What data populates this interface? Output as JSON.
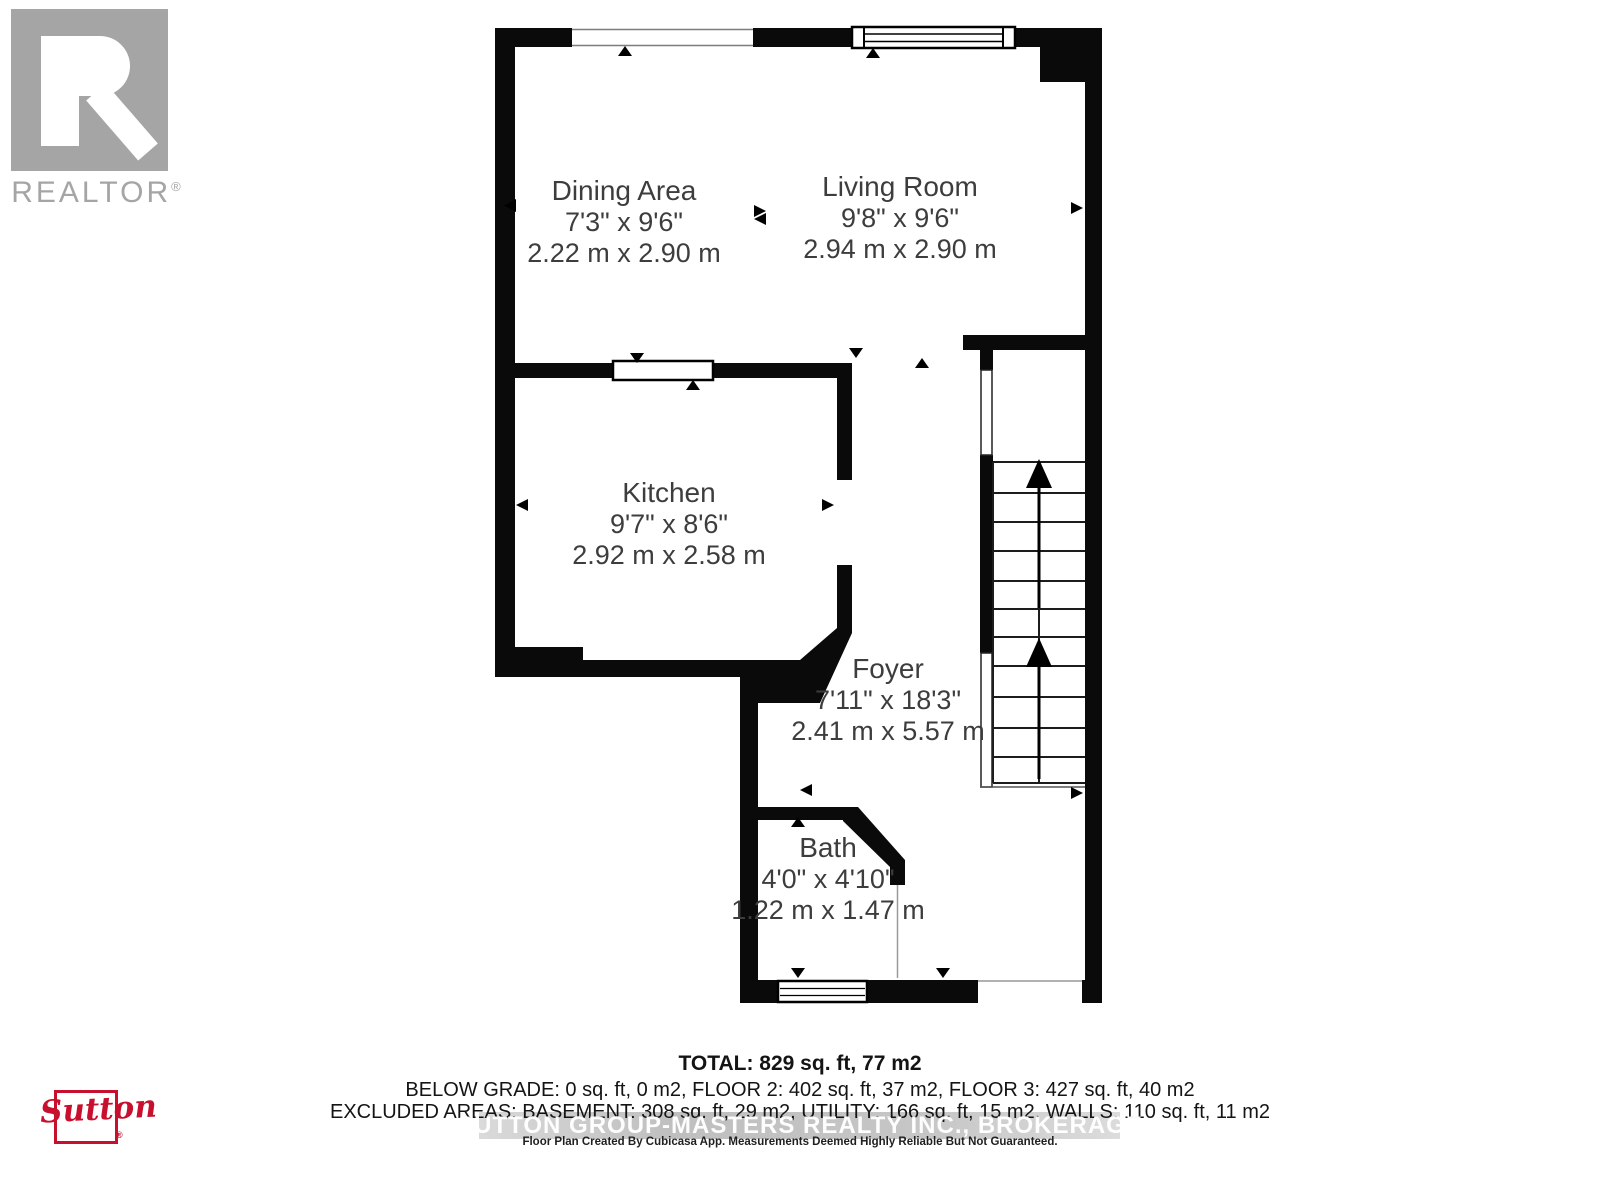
{
  "branding": {
    "realtor": {
      "wordmark": "REALTOR",
      "reg": "®"
    },
    "sutton": {
      "wordmark": "Sutton",
      "reg": "®",
      "color": "#c8102e"
    }
  },
  "rooms": {
    "dining": {
      "name": "Dining Area",
      "imperial": "7'3\" x 9'6\"",
      "metric": "2.22 m x 2.90 m"
    },
    "living": {
      "name": "Living Room",
      "imperial": "9'8\" x 9'6\"",
      "metric": "2.94 m x 2.90 m"
    },
    "kitchen": {
      "name": "Kitchen",
      "imperial": "9'7\" x 8'6\"",
      "metric": "2.92 m x 2.58 m"
    },
    "foyer": {
      "name": "Foyer",
      "imperial": "7'11\" x 18'3\"",
      "metric": "2.41 m x 5.57 m"
    },
    "bath": {
      "name": "Bath",
      "imperial": "4'0\" x 4'10\"",
      "metric": "1.22 m x 1.47 m"
    }
  },
  "summary": {
    "total": "TOTAL: 829 sq. ft, 77 m2",
    "below_grade_line": "BELOW GRADE: 0 sq. ft, 0 m2, FLOOR 2: 402 sq. ft, 37 m2, FLOOR 3: 427 sq. ft, 40 m2",
    "excluded_line": "EXCLUDED AREAS: BASEMENT: 308 sq. ft, 29 m2, UTILITY: 166 sq. ft, 15 m2, WALLS: 110 sq. ft, 11 m2",
    "watermark": "SUTTON GROUP-MASTERS REALTY INC., BROKERAGE",
    "disclaimer": "Floor Plan Created By Cubicasa App. Measurements Deemed Highly Reliable But Not Guaranteed."
  }
}
